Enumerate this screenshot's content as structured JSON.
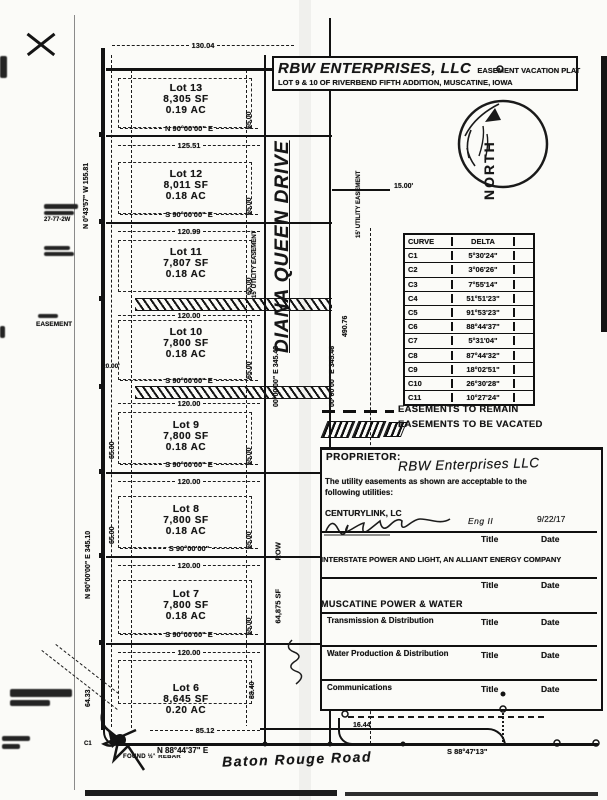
{
  "title_block": {
    "name": "RBW ENTERPRISES, LLC",
    "type": "EASEMENT VACATION PLAT",
    "subtitle": "LOT 9 & 10 OF RIVERBEND FIFTH ADDITION, MUSCATINE, IOWA"
  },
  "north": {
    "label": "NORTH"
  },
  "streets": {
    "diana_queen": "DIANA QUEEN DRIVE",
    "baton_rouge": "Baton Rouge Road"
  },
  "lots": [
    {
      "name": "Lot 13",
      "sf": "8,305 SF",
      "ac": "0.19 AC",
      "bearing": "N 90°00'00\" E",
      "dim": "125.51"
    },
    {
      "name": "Lot 12",
      "sf": "8,011 SF",
      "ac": "0.18 AC",
      "bearing": "S 90°00'00\" E",
      "dim": "120.99"
    },
    {
      "name": "Lot 11",
      "sf": "7,807 SF",
      "ac": "0.18 AC",
      "bearing": "S 90°00'00\" E",
      "dim": "120.00"
    },
    {
      "name": "Lot 10",
      "sf": "7,800 SF",
      "ac": "0.18 AC",
      "bearing": "S 90°00'00\" E",
      "dim": "120.00"
    },
    {
      "name": "Lot 9",
      "sf": "7,800 SF",
      "ac": "0.18 AC",
      "bearing": "S 90°00'00\" E",
      "dim": "120.00"
    },
    {
      "name": "Lot 8",
      "sf": "7,800 SF",
      "ac": "0.18 AC",
      "bearing": "S 90°00'00\"",
      "dim": "120.00"
    },
    {
      "name": "Lot 7",
      "sf": "7,800 SF",
      "ac": "0.18 AC",
      "bearing": "S 90°00'00\" E",
      "dim": "120.00"
    },
    {
      "name": "Lot 6",
      "sf": "8,645 SF",
      "ac": "0.20 AC",
      "bearing": "N 88°44'37\" E",
      "dim": "85.12"
    }
  ],
  "dims": {
    "top": "130.04",
    "side_65": "65.00",
    "lot6_side": "88.40",
    "west_lower": "64.33",
    "west_upper": "N 0°43'57\" W  155.81",
    "west_mid": "N 90°00'00\" E  345.10",
    "street_west": "00°00'00\" E  345.43",
    "street_east": "00°00'00\" E  345.46",
    "street_east_len": "490.76",
    "util_easement": "15' UTILITY EASEMENT",
    "util_dim": "15.00'",
    "row": "ROW",
    "row_area": "64,875 SF",
    "se_dim": "16.44",
    "se_bearing": "S 88°47'13\"",
    "c1": "C1",
    "c7": "C7",
    "found_rebar": "FOUND ½\" REBAR",
    "sec_ref": "27-77-2W",
    "easement": "EASEMENT",
    "easement_dim": "20.00'"
  },
  "curve_table": {
    "col1": "CURVE",
    "col2": "DELTA",
    "rows": [
      [
        "C1",
        "5°30'24\""
      ],
      [
        "C2",
        "3°06'26\""
      ],
      [
        "C3",
        "7°55'14\""
      ],
      [
        "C4",
        "51°51'23\""
      ],
      [
        "C5",
        "91°53'23\""
      ],
      [
        "C6",
        "88°44'37\""
      ],
      [
        "C7",
        "5°31'04\""
      ],
      [
        "C8",
        "87°44'32\""
      ],
      [
        "C9",
        "18°02'51\""
      ],
      [
        "C10",
        "26°30'28\""
      ],
      [
        "C11",
        "10°27'24\""
      ]
    ]
  },
  "legend": {
    "remain": "EASEMENTS TO REMAIN",
    "vacated": "EASEMENTS TO BE VACATED"
  },
  "proprietor": {
    "label": "PROPRIETOR:",
    "name": "RBW Enterprises LLC",
    "statement_1": "The utility easements as shown are acceptable to the",
    "statement_2": "following utilities:"
  },
  "signatures": {
    "title_label": "Title",
    "date_label": "Date"
  },
  "utilities": [
    {
      "company": "CENTURYLINK, LC",
      "sig_title": "Eng II",
      "sig_date": "9/22/17"
    },
    {
      "company": "INTERSTATE POWER AND LIGHT, AN ALLIANT ENERGY COMPANY"
    },
    {
      "company": "MUSCATINE POWER & WATER"
    }
  ],
  "mpw_departments": [
    {
      "label": "Transmission & Distribution"
    },
    {
      "label": "Water Production & Distribution"
    },
    {
      "label": "Communications"
    }
  ]
}
